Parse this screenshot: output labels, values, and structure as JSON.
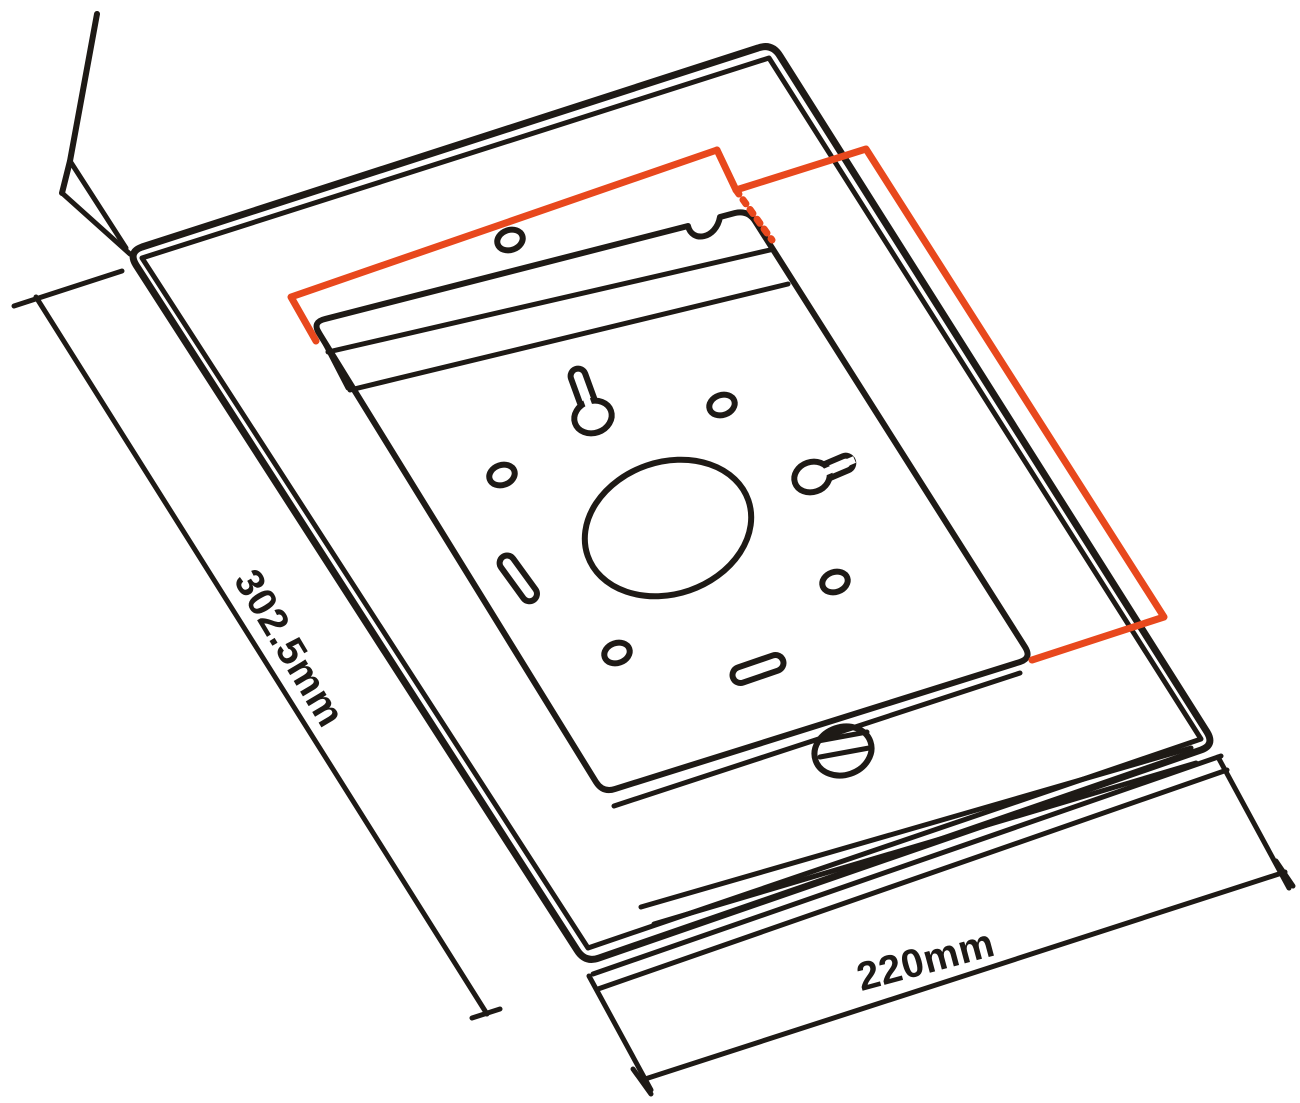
{
  "drawing": {
    "dimensions": {
      "height_label": "302.5mm",
      "width_label": "220mm"
    },
    "colors": {
      "line": "#1e1a16",
      "accent": "#e8481d",
      "background": "#ffffff"
    }
  }
}
